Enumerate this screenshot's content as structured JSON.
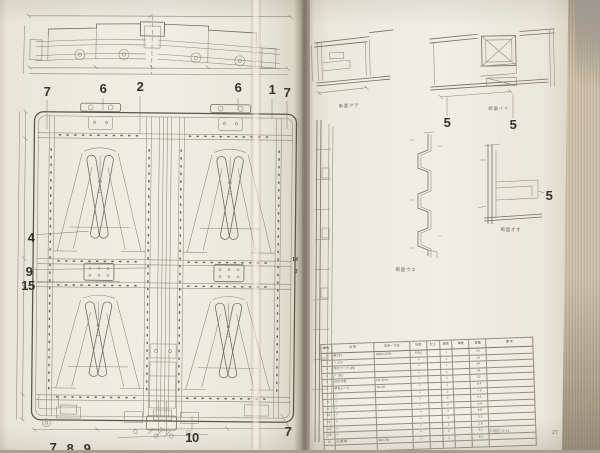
{
  "book": {
    "left_page": {
      "top_callouts": [
        "7",
        "6",
        "2",
        "6",
        "1",
        "7"
      ],
      "left_callouts": [
        "4",
        "9",
        "15"
      ],
      "right_edge_callouts": [
        "14",
        "3"
      ],
      "bottom_callouts": [
        "10",
        "7"
      ],
      "bottom_edge_callouts": [
        "7",
        "8",
        "9"
      ]
    },
    "right_page": {
      "detail_callouts": [
        "5",
        "5",
        "5"
      ],
      "captions": {
        "section_a": "断面アア",
        "section_b": "断面イイ",
        "profile": "断面ウエ",
        "corner": "断面オオ"
      },
      "footer": {
        "doc_number": "詳細図 9-11",
        "page_number": "27"
      },
      "parts_table": {
        "col_widths": [
          "5%",
          "20%",
          "17%",
          "8%",
          "6%",
          "6%",
          "8%",
          "8%",
          "22%"
        ],
        "headers": [
          "番号",
          "名 称",
          "形状・寸法",
          "材質",
          "仕上",
          "員数",
          "単重",
          "重量",
          "備 考"
        ],
        "rows": [
          [
            "1",
            "扉 (大)",
            "1800×2250",
            "SS41",
            "",
            "1",
            "",
            "25",
            ""
          ],
          [
            "2",
            "〃 (小)",
            "",
            "〃",
            "",
            "1",
            "",
            "14",
            ""
          ],
          [
            "3",
            "吊りフード (右)",
            "",
            "〃",
            "",
            "1",
            "",
            "24",
            ""
          ],
          [
            "4",
            "〃 (左)",
            "",
            "〃",
            "",
            "1",
            "",
            "24",
            ""
          ],
          [
            "5",
            "召合せ框",
            "FB 32×6",
            "〃",
            "",
            "1",
            "",
            "13",
            ""
          ],
          [
            "6",
            "甲丸レール",
            "No.10",
            "〃",
            "",
            "1",
            "",
            "8.4",
            ""
          ],
          [
            "7",
            "〃",
            "",
            "〃",
            "",
            "2",
            "",
            "7.5",
            ""
          ],
          [
            "8",
            "〃",
            "",
            "〃",
            "",
            "2",
            "",
            "6.1",
            ""
          ],
          [
            "9",
            "〃",
            "",
            "〃",
            "",
            "2",
            "",
            "5.4",
            ""
          ],
          [
            "10",
            "〃",
            "",
            "〃",
            "",
            "2",
            "",
            "4.8",
            ""
          ],
          [
            "11",
            "〃",
            "",
            "〃",
            "",
            "2",
            "",
            "3.2",
            ""
          ],
          [
            "12",
            "〃",
            "",
            "〃",
            "",
            "2",
            "",
            "2.6",
            ""
          ],
          [
            "13",
            "〃",
            "",
            "〃",
            "",
            "2",
            "",
            "2.1",
            ""
          ],
          [
            "14",
            "丸 鋼 棒",
            "9φ×760",
            "〃",
            "",
            "1",
            "",
            "8.1",
            ""
          ],
          [
            "",
            "",
            "",
            "",
            "",
            "",
            "",
            "",
            ""
          ]
        ]
      }
    }
  },
  "colors": {
    "paper": "#efeee2",
    "line": "#736d5f",
    "ink": "#35332c",
    "backdrop": "#a89f92"
  }
}
